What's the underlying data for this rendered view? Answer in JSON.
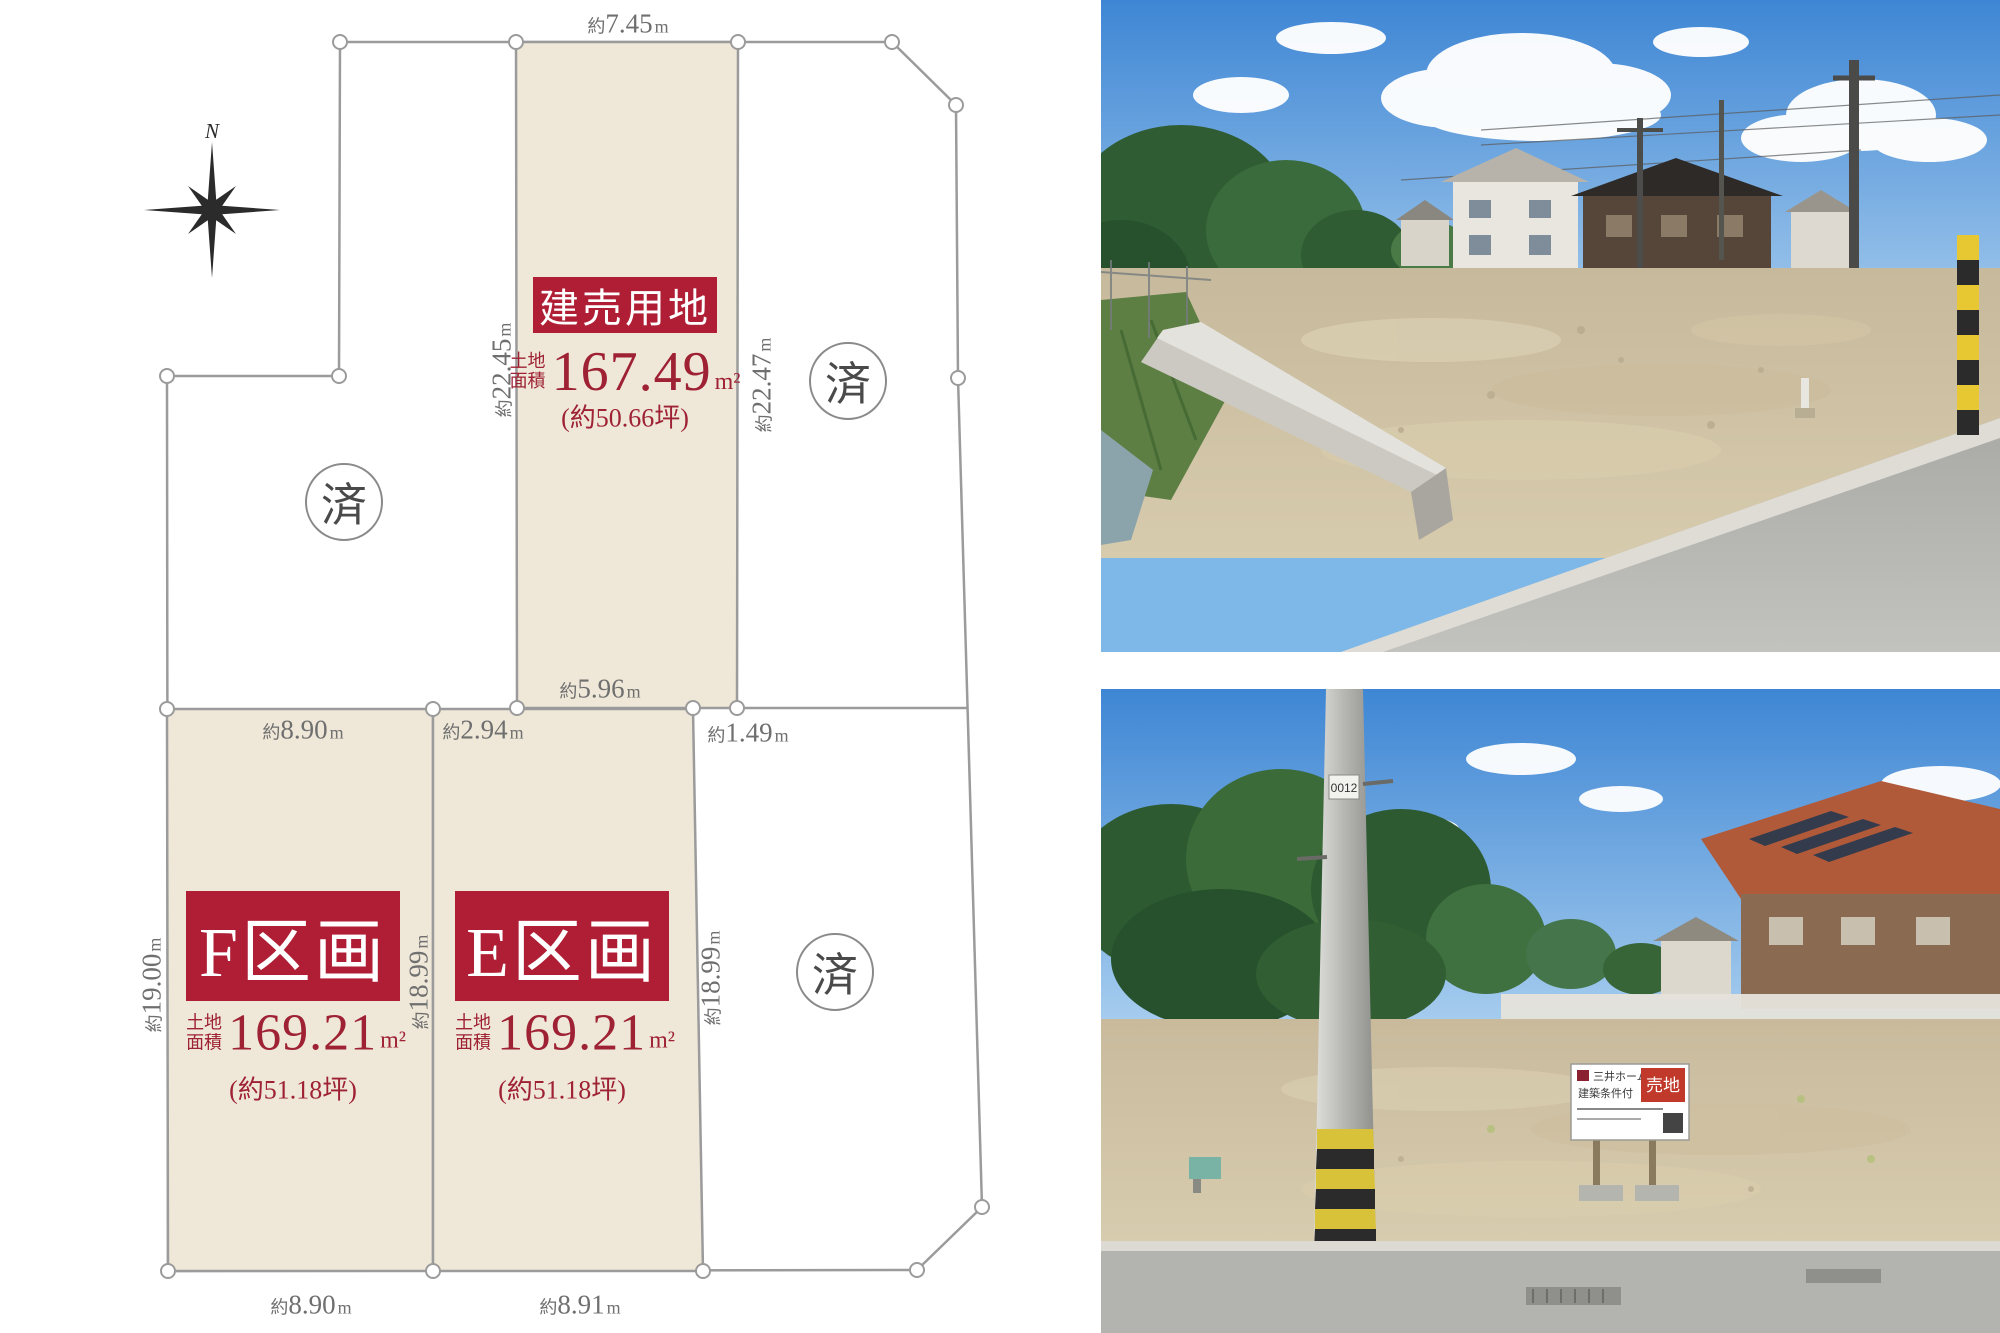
{
  "colors": {
    "accent": "#b01e35",
    "area_text": "#9e2134",
    "plot_fill": "#efe8d8",
    "line_gray": "#9b9b9b",
    "dim_text": "#6f6f6f"
  },
  "site_plan": {
    "compass_label": "N",
    "sold_mark": "済",
    "dims": {
      "d745": {
        "p": "約",
        "v": "7.45",
        "u": "m"
      },
      "d2245": {
        "p": "約",
        "v": "22.45",
        "u": "m"
      },
      "d2247": {
        "p": "約",
        "v": "22.47",
        "u": "m"
      },
      "d596": {
        "p": "約",
        "v": "5.96",
        "u": "m"
      },
      "d890t": {
        "p": "約",
        "v": "8.90",
        "u": "m"
      },
      "d294": {
        "p": "約",
        "v": "2.94",
        "u": "m"
      },
      "d149": {
        "p": "約",
        "v": "1.49",
        "u": "m"
      },
      "d1900": {
        "p": "約",
        "v": "19.00",
        "u": "m"
      },
      "d1899m": {
        "p": "約",
        "v": "18.99",
        "u": "m"
      },
      "d1899r": {
        "p": "約",
        "v": "18.99",
        "u": "m"
      },
      "d890b": {
        "p": "約",
        "v": "8.90",
        "u": "m"
      },
      "d891": {
        "p": "約",
        "v": "8.91",
        "u": "m"
      }
    },
    "plots": {
      "build": {
        "name": "建売用地",
        "area_label1": "土地",
        "area_label2": "面積",
        "area_value": "167.49",
        "area_unit": "m²",
        "tsubo": "(約50.66坪)"
      },
      "f": {
        "name": "F区画",
        "area_label1": "土地",
        "area_label2": "面積",
        "area_value": "169.21",
        "area_unit": "m²",
        "tsubo": "(約51.18坪)"
      },
      "e": {
        "name": "E区画",
        "area_label1": "土地",
        "area_label2": "面積",
        "area_value": "169.21",
        "area_unit": "m²",
        "tsubo": "(約51.18坪)"
      }
    }
  },
  "photos": {
    "bottom_sign": {
      "brand": "三井ホーム",
      "condition": "建築条件付",
      "main": "売地"
    },
    "pole_plate": "0012"
  }
}
